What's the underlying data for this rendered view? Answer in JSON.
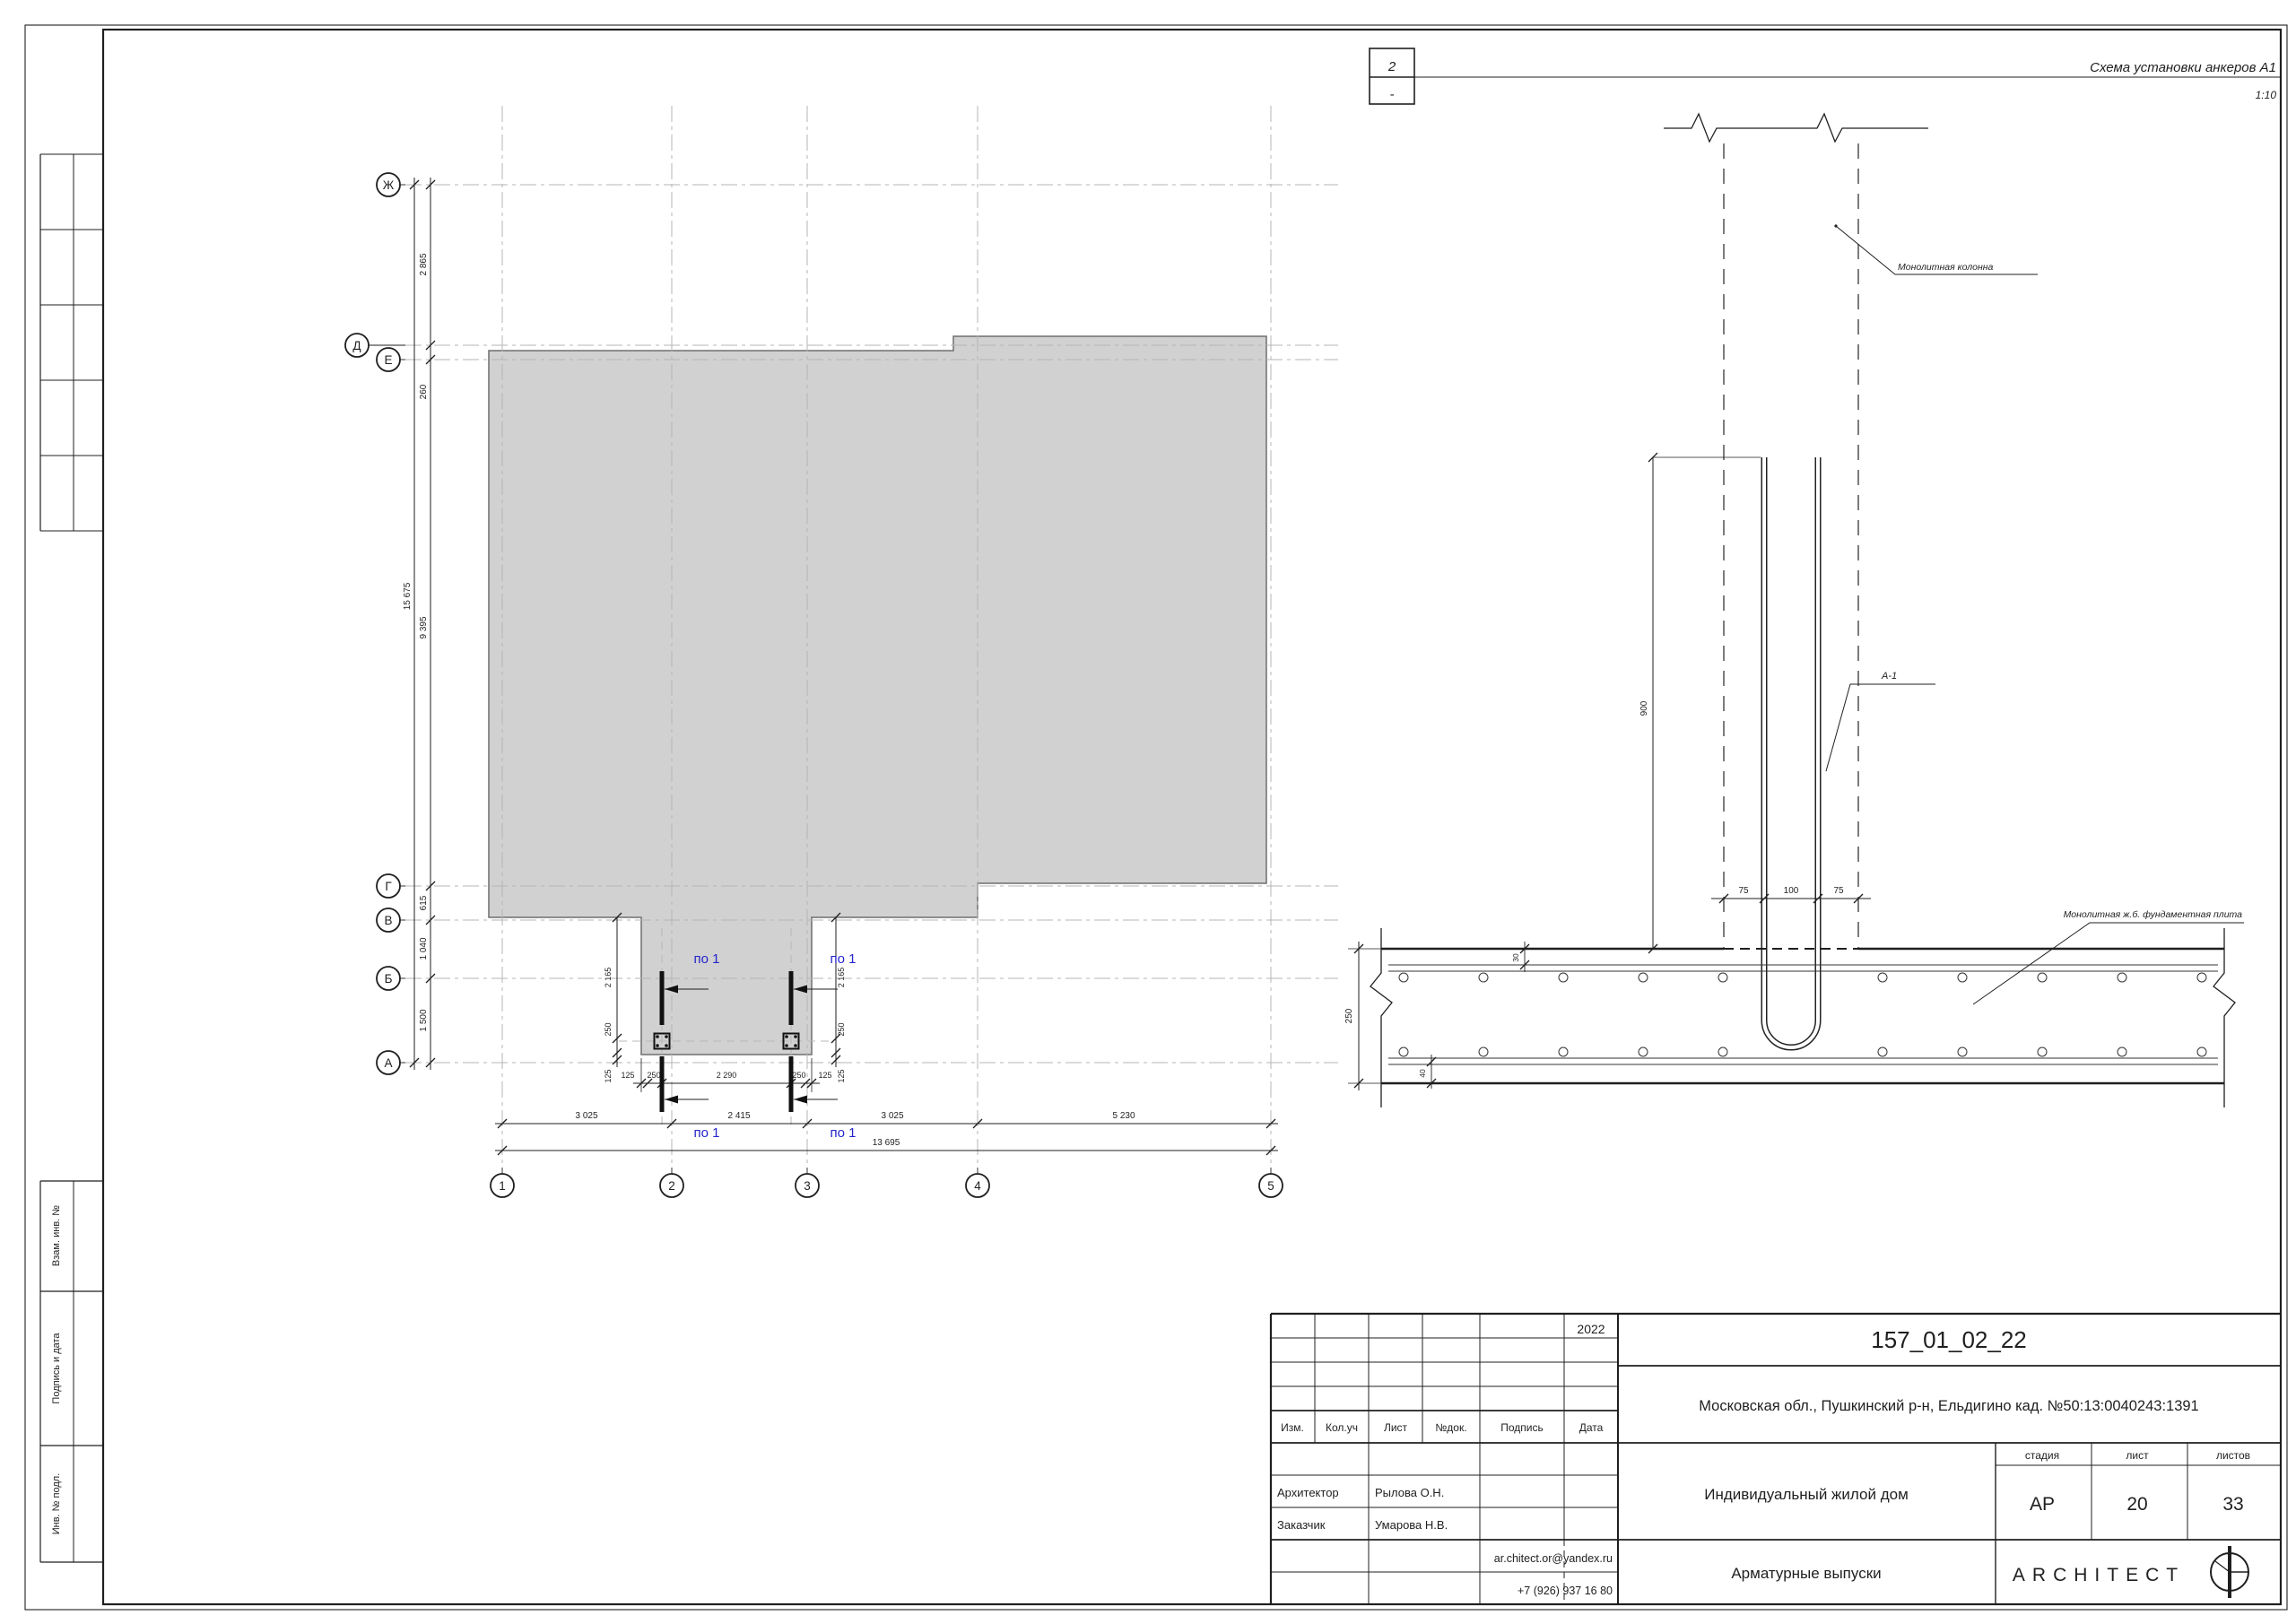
{
  "marker": {
    "number": "2",
    "sub": "-",
    "title": "Схема установки анкеров А1",
    "scale": "1:10"
  },
  "plan": {
    "row_axes": [
      "Ж",
      "Д",
      "Е",
      "Г",
      "В",
      "Б",
      "А"
    ],
    "col_axes": [
      "1",
      "2",
      "3",
      "4",
      "5"
    ],
    "left_total": "15 675",
    "left_dims": [
      "2 865",
      "260",
      "9 395",
      "615",
      "1 040",
      "1 500"
    ],
    "bottom_dims": [
      "3 025",
      "2 415",
      "3 025",
      "5 230"
    ],
    "bottom_total": "13 695",
    "cut_label": "по 1",
    "detail_h_dims": [
      "125",
      "250",
      "2 290",
      "250",
      "125"
    ],
    "detail_v_dims": [
      "2 165",
      "250",
      "125"
    ]
  },
  "section": {
    "column_label": "Монолитная колонна",
    "rebar_label": "А-1",
    "slab_label": "Монолитная ж.б. фундаментная плита",
    "dim_height": "900",
    "dim_left": "75",
    "dim_mid": "100",
    "dim_right": "75",
    "dim_thickness": "250",
    "dim_top_cover": "30",
    "dim_bottom_cover": "40"
  },
  "stamp": {
    "year": "2022",
    "code": "157_01_02_22",
    "address": "Московская обл., Пушкинский р-н, Ельдигино кад. №50:13:0040243:1391",
    "cols": [
      "Изм.",
      "Кол.уч",
      "Лист",
      "№док.",
      "Подпись",
      "Дата"
    ],
    "role1": "Архитектор",
    "name1": "Рылова О.Н.",
    "role2": "Заказчик",
    "name2": "Умарова Н.В.",
    "email": "ar.chitect.or@yandex.ru",
    "phone": "+7 (926) 937 16 80",
    "object": "Индивидуальный жилой дом",
    "stage_h": "стадия",
    "sheet_h": "лист",
    "sheets_h": "листов",
    "stage": "АР",
    "sheet": "20",
    "sheets": "33",
    "title": "Арматурные выпуски",
    "brand": "ARCHITECT"
  },
  "strip": {
    "labels": [
      "Взам. инв. №",
      "Подпись и дата",
      "Инв. № подл."
    ]
  },
  "colors": {
    "ink": "#1f1f1f",
    "grid": "#b5b5b5",
    "slab_fill": "#d1d1d1",
    "blue": "#2424cc"
  }
}
